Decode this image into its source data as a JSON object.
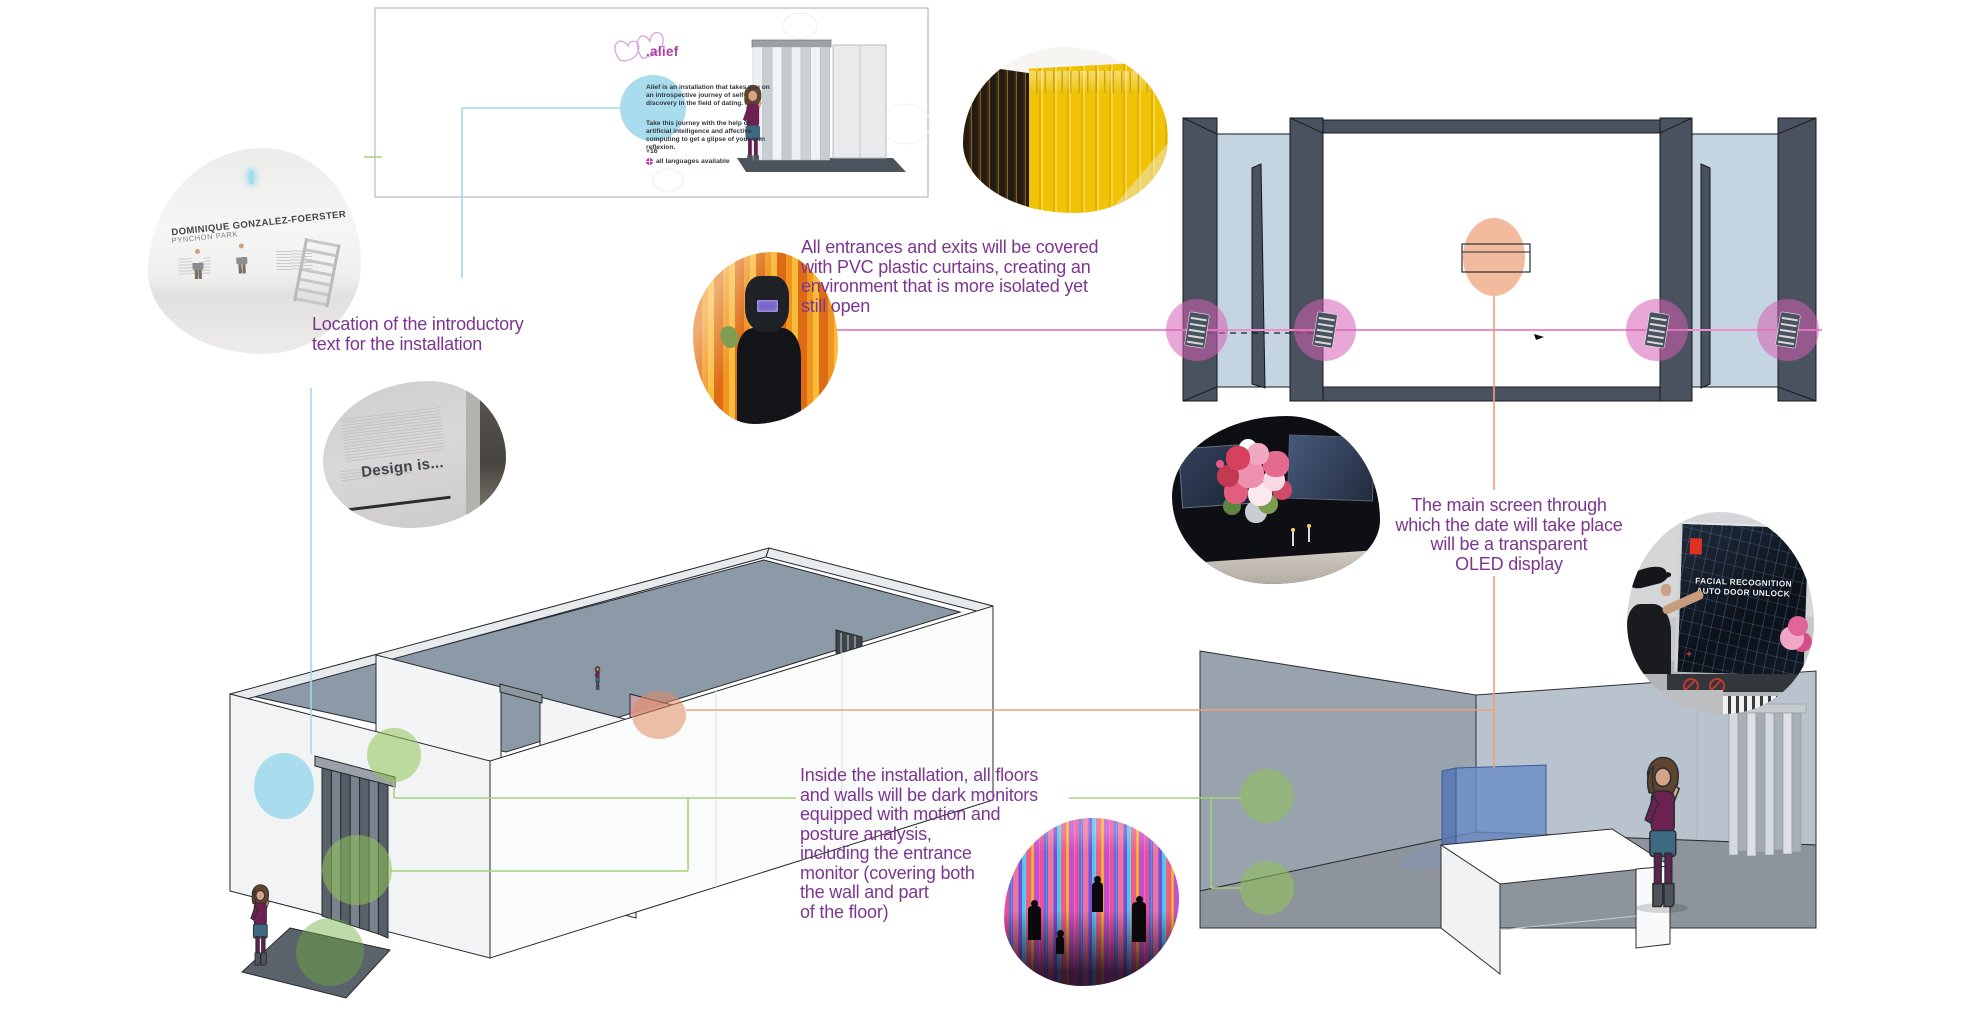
{
  "annotations": {
    "intro_location": {
      "lines": [
        "Location of the introductory",
        "text for the installation"
      ]
    },
    "pvc_curtains": {
      "lines": [
        "All entrances and exits will be covered",
        "with PVC plastic curtains, creating an",
        "environment that is more isolated yet",
        "still open"
      ]
    },
    "oled_screen": {
      "lines": [
        "The main screen through",
        "which the date will take place",
        "will be a transparent",
        "OLED display"
      ]
    },
    "dark_monitors": {
      "lines": [
        "Inside the installation, all floors",
        "and walls will be dark monitors",
        "equipped with motion and",
        "posture analysis,",
        "including the entrance",
        "monitor (covering both",
        "the wall and part",
        "of the floor)"
      ]
    }
  },
  "intro_panel": {
    "logo": ".alief",
    "paragraph_1": "Alief is an installation that takes you on an introspective journey of self-discovery in the field of dating.",
    "paragraph_2": "Take this journey with the help of artificial intelligence and affective computing to get a glipse of your own reflexion.",
    "age_rating": "+16",
    "languages_note": "all languages available"
  },
  "photos": {
    "gallery_title": "DOMINIQUE GONZALEZ-FOERSTER",
    "gallery_subtitle": "PYNCHON PARK",
    "design_wall_text": "Design is...",
    "oled_demo": {
      "lines": [
        "FACIAL RECOGNITION",
        "AUTO DOOR UNLOCK"
      ]
    }
  },
  "colors": {
    "annotation_purple": "#7d3690",
    "logo_magenta": "#b03ea0",
    "highlight_cyan": "#a9dcec",
    "highlight_green": "#8fc455",
    "green_line": "#a6d37d",
    "highlight_pink": "#d55fb5",
    "pink_line": "#ee8fcd",
    "highlight_orange": "#efa47c",
    "orange_line": "#eda177",
    "plan_slate": "#49525e",
    "plan_glass_blue": "#c5d4e1"
  }
}
